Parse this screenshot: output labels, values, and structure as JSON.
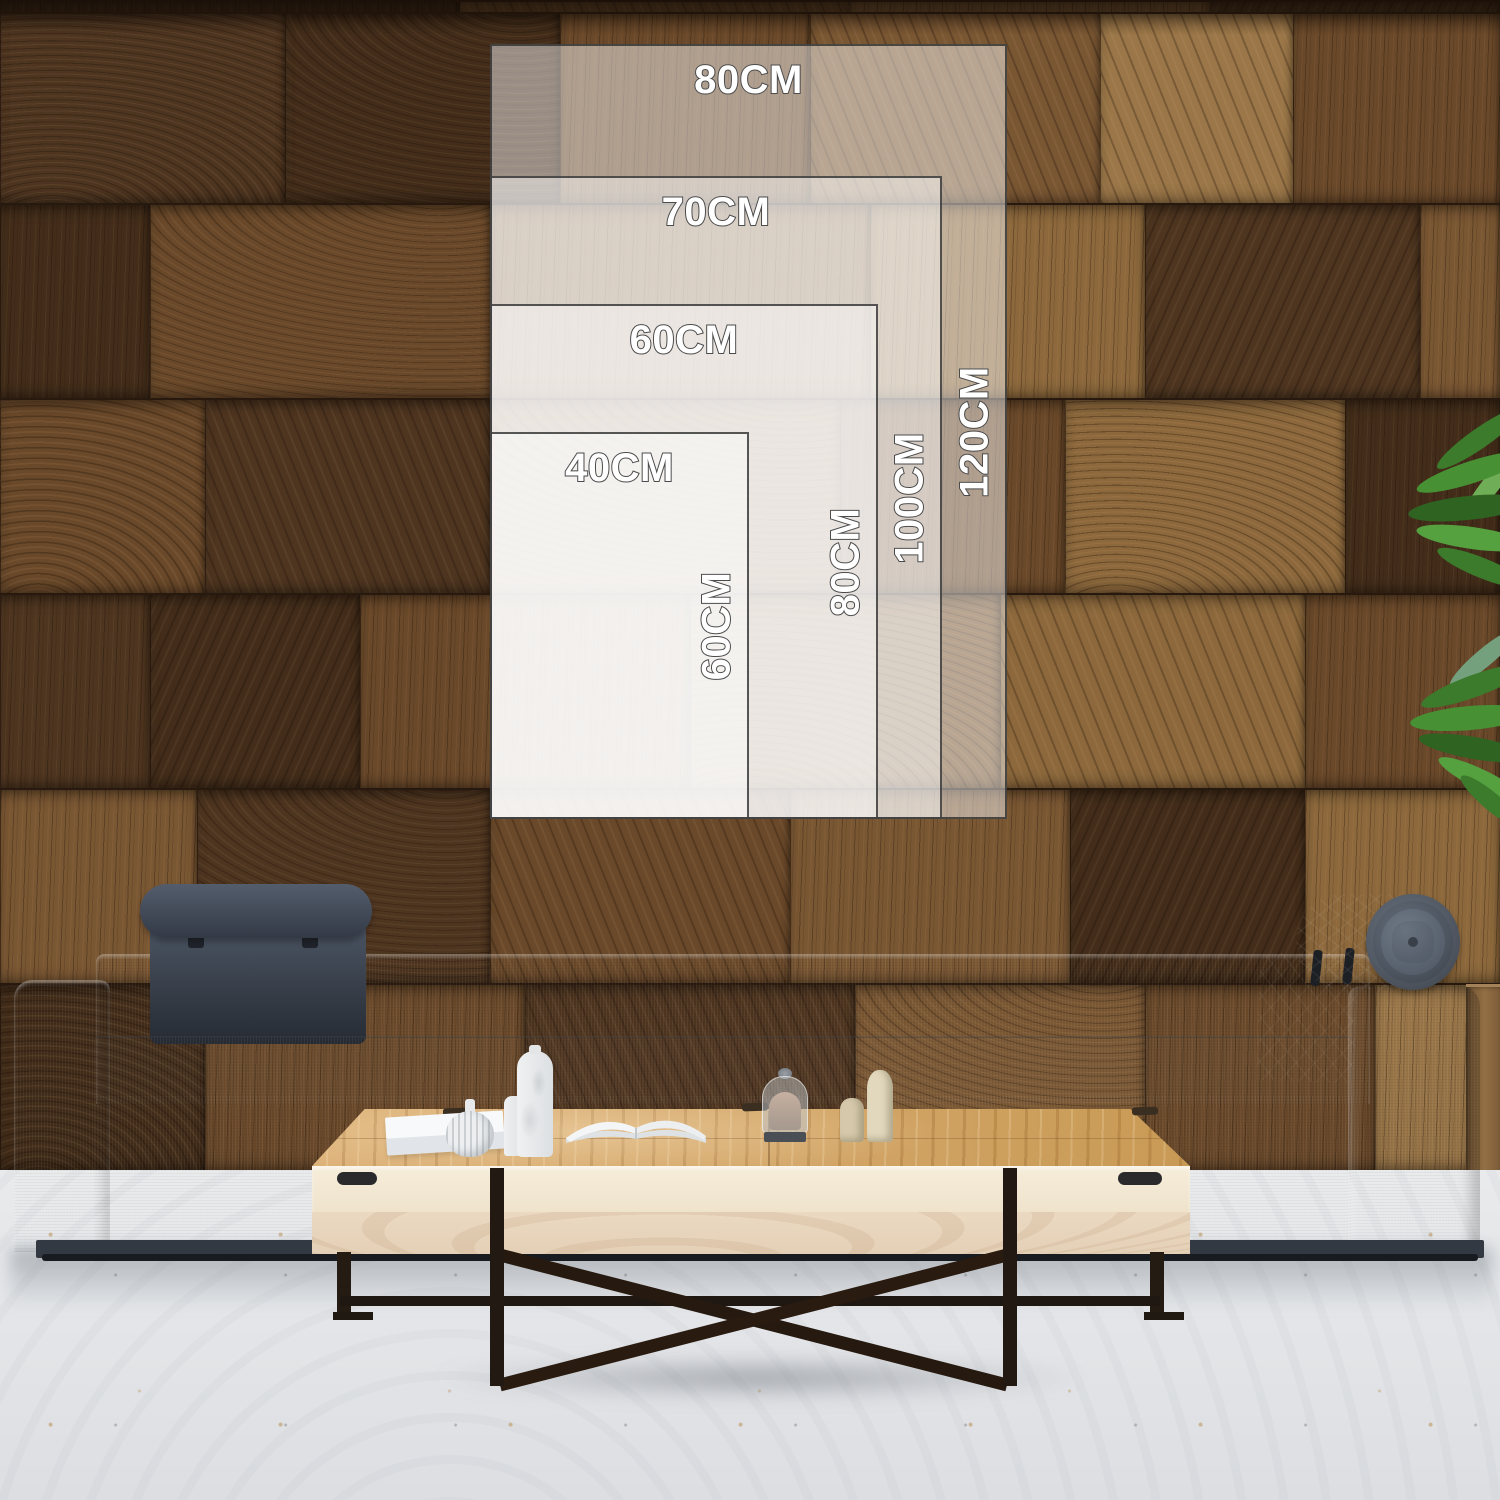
{
  "size_chart": {
    "unit": "CM",
    "sizes": [
      {
        "width_label": "80CM",
        "height_label": "120CM",
        "width_cm": 80,
        "height_cm": 120
      },
      {
        "width_label": "70CM",
        "height_label": "100CM",
        "width_cm": 70,
        "height_cm": 100
      },
      {
        "width_label": "60CM",
        "height_label": "80CM",
        "width_cm": 60,
        "height_cm": 80
      },
      {
        "width_label": "40CM",
        "height_label": "60CM",
        "width_cm": 40,
        "height_cm": 60
      }
    ],
    "colors": {
      "overlay_fill": "rgba(255,255,255,0.47)",
      "overlay_border": "#3d3d3d",
      "label_fill": "#ffffff",
      "label_outline": "#4b4b4b"
    }
  }
}
